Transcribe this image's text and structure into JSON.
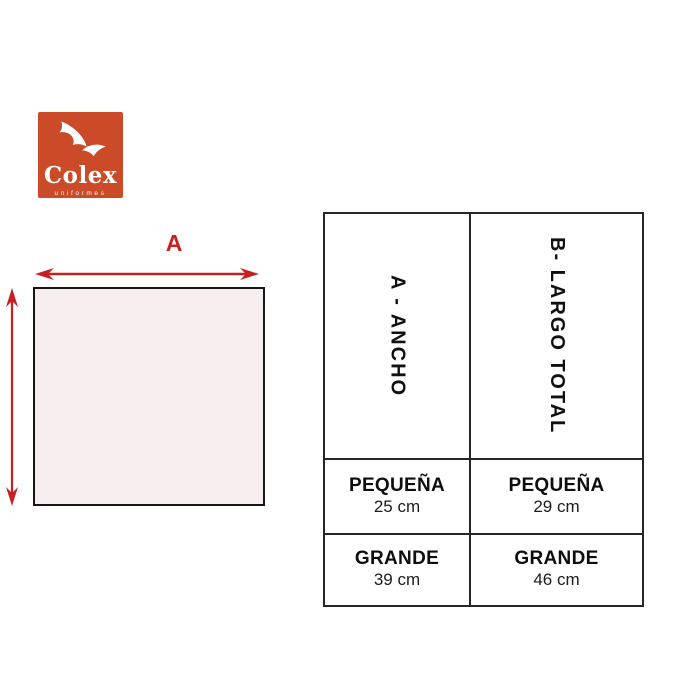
{
  "colors": {
    "brand_red": "#cb4a27",
    "arrow_red": "#c81f1f",
    "square_fill": "#f6eeee",
    "wing_white": "#ffffff"
  },
  "logo": {
    "brand": "Colex",
    "tagline": "uniformes"
  },
  "diagram": {
    "width_arrow_label": "A"
  },
  "size_table": {
    "columns": [
      {
        "header": "A - ANCHO",
        "rows": [
          {
            "size": "PEQUEÑA",
            "value": "25 cm"
          },
          {
            "size": "GRANDE",
            "value": "39 cm"
          }
        ]
      },
      {
        "header": "B- LARGO TOTAL",
        "rows": [
          {
            "size": "PEQUEÑA",
            "value": "29 cm"
          },
          {
            "size": "GRANDE",
            "value": "46 cm"
          }
        ]
      }
    ]
  }
}
